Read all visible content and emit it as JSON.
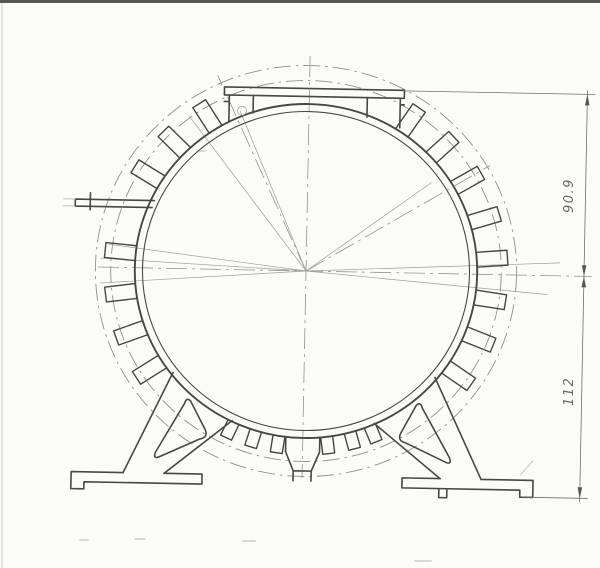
{
  "meta": {
    "description": "Scanned engineering cross-section drawing of a circular finned extrusion housing with mounting feet",
    "paper_color": "#fbfbf9",
    "line_color": "#474747",
    "phantom_color": "#909090"
  },
  "dimensions": {
    "vertical_upper": {
      "value": "90.9"
    },
    "vertical_lower": {
      "value": "112"
    }
  },
  "drawing": {
    "cx": 306,
    "cy": 271,
    "skew_deg": 1.1,
    "x_scale": 1.025,
    "ring": {
      "r_outer": 167,
      "r_inner": 159.5
    },
    "phantom_radii": [
      190.5,
      205.5
    ],
    "fins": {
      "angles": [
        123,
        136,
        149,
        175,
        188,
        201,
        214,
        326,
        339,
        352,
        5,
        18,
        31,
        44,
        57
      ],
      "r1": 167,
      "r2": 197,
      "half_w": 7.5
    },
    "bottom_fins": {
      "angles": [
        246,
        254,
        262,
        278,
        286,
        293
      ],
      "r1": 167,
      "r2": 184,
      "half_w": 6
    },
    "center_lines": [
      [
        306,
        56,
        306,
        478
      ],
      [
        98,
        271,
        592,
        271
      ]
    ],
    "diag_center_lines": [
      [
        306,
        271,
        214,
        77
      ],
      [
        306,
        271,
        488,
        162
      ]
    ],
    "construction_lines": [
      [
        237,
        112
      ],
      [
        186,
        118
      ],
      [
        108,
        248
      ],
      [
        100,
        262
      ],
      [
        100,
        287
      ],
      [
        430,
        180
      ],
      [
        560,
        258
      ],
      [
        548,
        290
      ]
    ],
    "marker": {
      "x": 239,
      "y": 112,
      "r": 4.5
    },
    "paths": [
      {
        "n": "top-plate",
        "c": "main",
        "d": "M221,88.5 H401 V96.5 H221 Z"
      },
      {
        "n": "plate-stub-left",
        "c": "main",
        "d": "M226,96.5 V122 M250,96.5 V114 M221,103 H226"
      },
      {
        "n": "plate-stub-right",
        "c": "main",
        "d": "M364,96.5 V116 M397,96.5 V126 M397,103 H401"
      },
      {
        "n": "terminal-tab-left",
        "c": "main",
        "d": "M153,203.5 H74 V210.5 H151 M89,197 V214"
      },
      {
        "n": "terminal-tab-ghost",
        "c": "thin2",
        "d": "M62,203.5 H74 M62,210.5 H74"
      },
      {
        "n": "bottom-channel",
        "c": "main",
        "d": "M289,437 V452 L297,471 H315 L323,452 V437 M297,471 V481 M315,471 V481"
      },
      {
        "n": "leg-left",
        "c": "main",
        "d": "M175,375 L127,476 M235,422 L168,476"
      },
      {
        "n": "leg-left-cutout",
        "c": "main",
        "d": "M193,403 L208,431 Q212,439 203,441 L164,459 Q156,463 159,455 L187,406 Q189,399 193,403 Z"
      },
      {
        "n": "foot-left",
        "c": "main",
        "d": "M127,476 H75 V493 H88 V486 H206 V476 H168"
      },
      {
        "n": "leg-right",
        "c": "main",
        "d": "M437,375 L485,476 M377,422 L444,476"
      },
      {
        "n": "leg-right-cutout",
        "c": "main",
        "d": "M419,403 L404,431 Q400,439 409,441 L448,459 Q456,463 453,455 L425,406 Q423,399 419,403 Z"
      },
      {
        "n": "foot-right",
        "c": "main",
        "d": "M485,476 H537 V493 H524 V486 H406 V476 H444 M443,486 V495 H451 V486"
      },
      {
        "n": "foot-right-leader",
        "c": "thin2",
        "d": "M524,471 L537,456"
      }
    ],
    "dim": {
      "x": 584,
      "y_top": 89,
      "y_mid": 271,
      "y_bot": 493,
      "overshoot": 4,
      "ext": [
        [
          401,
          89,
          592,
          89
        ],
        [
          527,
          493,
          592,
          493
        ]
      ],
      "arrows": [
        [
          584,
          89,
          "up"
        ],
        [
          584,
          271,
          "down"
        ],
        [
          584,
          271,
          "up"
        ],
        [
          584,
          493,
          "down"
        ]
      ]
    },
    "smudges": [
      "M80,540 h8",
      "M135,539 h10",
      "M243,541 h12",
      "M415,561 h16",
      "M200,151 h5"
    ]
  }
}
